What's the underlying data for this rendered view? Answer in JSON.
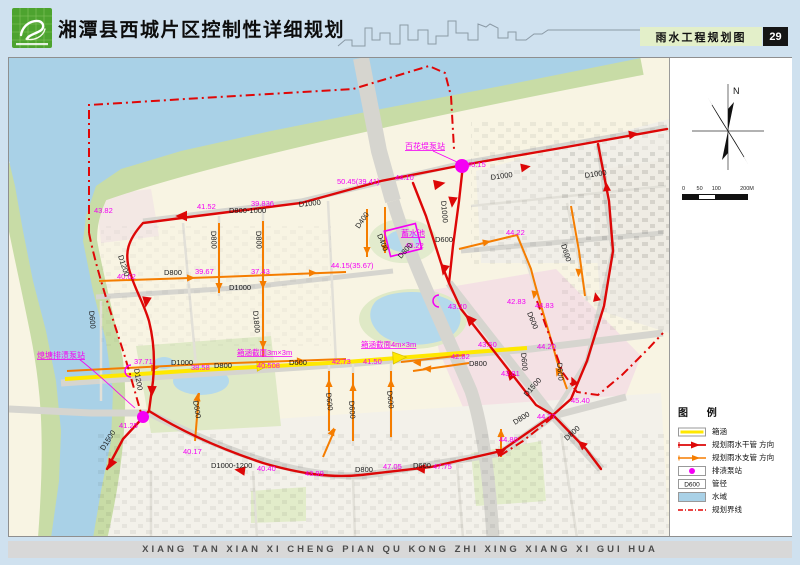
{
  "header": {
    "title": "湘潭县西城片区控制性详细规划",
    "map_label": "雨水工程规划图",
    "page_number": "29"
  },
  "footer": {
    "text": "XIANG TAN XIAN XI CHENG PIAN QU KONG ZHI XING XIANG XI GUI HUA"
  },
  "compass": {
    "north_label": "N"
  },
  "scale_bar": {
    "ticks": [
      "0",
      "50",
      "100",
      "200M"
    ]
  },
  "legend": {
    "title": "图  例",
    "items": [
      {
        "symbol": "culvert",
        "label": "箱涵"
      },
      {
        "symbol": "main-pipe",
        "label": "规划雨水干管  方向"
      },
      {
        "symbol": "branch-pipe",
        "label": "规划雨水支管  方向"
      },
      {
        "symbol": "pump-station",
        "label": "排渍泵站"
      },
      {
        "symbol": "diameter",
        "label": "管径",
        "swatch_text": "D600"
      },
      {
        "symbol": "water",
        "label": "水域"
      },
      {
        "symbol": "boundary",
        "label": "规划界线"
      }
    ]
  },
  "map": {
    "colors": {
      "main_pipe": "#dd0707",
      "branch_pipe": "#f57d00",
      "culvert": "#ffe800",
      "pump": "#f400f4",
      "water": "#a9d1e7",
      "boundary": "#e00707"
    },
    "annotations": [
      {
        "t": "43.82",
        "x": 93,
        "y": 212
      },
      {
        "t": "41.52",
        "x": 196,
        "y": 208
      },
      {
        "t": "39.836",
        "x": 250,
        "y": 205
      },
      {
        "t": "50.45(39.41)",
        "x": 336,
        "y": 183
      },
      {
        "t": "44.10",
        "x": 394,
        "y": 179
      },
      {
        "t": "百花堤泵站",
        "x": 404,
        "y": 148,
        "u": 1,
        "fs": 8
      },
      {
        "t": "40.15",
        "x": 466,
        "y": 166
      },
      {
        "t": "蓄水池",
        "x": 400,
        "y": 235,
        "u": 1,
        "fs": 8
      },
      {
        "t": "40.22",
        "x": 404,
        "y": 247
      },
      {
        "t": "44.15(35.67)",
        "x": 330,
        "y": 267
      },
      {
        "t": "44.22",
        "x": 505,
        "y": 234
      },
      {
        "t": "42.83",
        "x": 506,
        "y": 303
      },
      {
        "t": "43.20",
        "x": 447,
        "y": 308
      },
      {
        "t": "44.83",
        "x": 534,
        "y": 307
      },
      {
        "t": "43.50",
        "x": 477,
        "y": 346
      },
      {
        "t": "42.82",
        "x": 450,
        "y": 358
      },
      {
        "t": "44.20",
        "x": 536,
        "y": 348
      },
      {
        "t": "43.81",
        "x": 500,
        "y": 375
      },
      {
        "t": "42.73",
        "x": 331,
        "y": 363
      },
      {
        "t": "41.50",
        "x": 362,
        "y": 363
      },
      {
        "t": "40.508",
        "x": 256,
        "y": 367
      },
      {
        "t": "38.58",
        "x": 190,
        "y": 369
      },
      {
        "t": "37.71",
        "x": 133,
        "y": 363
      },
      {
        "t": "39.67",
        "x": 194,
        "y": 273
      },
      {
        "t": "37.43",
        "x": 250,
        "y": 273
      },
      {
        "t": "40.62",
        "x": 116,
        "y": 278
      },
      {
        "t": "熄塘排渍泵站",
        "x": 36,
        "y": 357,
        "u": 1,
        "fs": 8
      },
      {
        "t": "41.25",
        "x": 118,
        "y": 427
      },
      {
        "t": "40.17",
        "x": 182,
        "y": 453
      },
      {
        "t": "40.40",
        "x": 256,
        "y": 470
      },
      {
        "t": "43.99",
        "x": 304,
        "y": 475
      },
      {
        "t": "47.05",
        "x": 382,
        "y": 468
      },
      {
        "t": "47.75",
        "x": 432,
        "y": 468
      },
      {
        "t": "44.80",
        "x": 498,
        "y": 441
      },
      {
        "t": "44.77",
        "x": 536,
        "y": 418
      },
      {
        "t": "45.40",
        "x": 570,
        "y": 402
      },
      {
        "t": "箱涵截面3m×3m",
        "x": 236,
        "y": 354,
        "u": 1
      },
      {
        "t": "箱涵截面4m×3m",
        "x": 360,
        "y": 346,
        "u": 1
      },
      {
        "t": "D800-1000",
        "x": 228,
        "y": 212,
        "c": "k"
      },
      {
        "t": "D1000",
        "x": 298,
        "y": 206,
        "c": "k",
        "r": -6
      },
      {
        "t": "D1000",
        "x": 490,
        "y": 179,
        "c": "k",
        "r": -8
      },
      {
        "t": "D1000",
        "x": 584,
        "y": 177,
        "c": "k",
        "r": -8
      },
      {
        "t": "D1000",
        "x": 440,
        "y": 200,
        "c": "k",
        "r": 85
      },
      {
        "t": "D800",
        "x": 210,
        "y": 230,
        "c": "k",
        "r": 88
      },
      {
        "t": "D800",
        "x": 255,
        "y": 230,
        "c": "k",
        "r": 88
      },
      {
        "t": "D1200",
        "x": 117,
        "y": 255,
        "c": "k",
        "r": 72
      },
      {
        "t": "D800",
        "x": 163,
        "y": 274,
        "c": "k"
      },
      {
        "t": "D1000",
        "x": 228,
        "y": 289,
        "c": "k"
      },
      {
        "t": "D1800",
        "x": 252,
        "y": 310,
        "c": "k",
        "r": 85
      },
      {
        "t": "D600",
        "x": 88,
        "y": 310,
        "c": "k",
        "r": 85
      },
      {
        "t": "D1200",
        "x": 133,
        "y": 368,
        "c": "k",
        "r": 80
      },
      {
        "t": "D1000",
        "x": 170,
        "y": 364,
        "c": "k"
      },
      {
        "t": "D800",
        "x": 213,
        "y": 367,
        "c": "k"
      },
      {
        "t": "D600",
        "x": 288,
        "y": 364,
        "c": "k"
      },
      {
        "t": "D400",
        "x": 358,
        "y": 228,
        "c": "k",
        "r": -55
      },
      {
        "t": "D400",
        "x": 376,
        "y": 234,
        "c": "k",
        "r": 68
      },
      {
        "t": "D800",
        "x": 400,
        "y": 258,
        "c": "k",
        "r": -48
      },
      {
        "t": "D600",
        "x": 434,
        "y": 241,
        "c": "k"
      },
      {
        "t": "D600",
        "x": 325,
        "y": 392,
        "c": "k",
        "r": 84
      },
      {
        "t": "D600",
        "x": 348,
        "y": 400,
        "c": "k",
        "r": 86
      },
      {
        "t": "D600",
        "x": 386,
        "y": 390,
        "c": "k",
        "r": 84
      },
      {
        "t": "D600",
        "x": 192,
        "y": 400,
        "c": "k",
        "r": 80
      },
      {
        "t": "D1500",
        "x": 103,
        "y": 450,
        "c": "k",
        "r": -58
      },
      {
        "t": "D1000-1200",
        "x": 210,
        "y": 467,
        "c": "k"
      },
      {
        "t": "D800",
        "x": 354,
        "y": 471,
        "c": "k"
      },
      {
        "t": "D600",
        "x": 412,
        "y": 467,
        "c": "k"
      },
      {
        "t": "D600",
        "x": 526,
        "y": 312,
        "c": "k",
        "r": 68
      },
      {
        "t": "D600",
        "x": 520,
        "y": 352,
        "c": "k",
        "r": 85
      },
      {
        "t": "D600",
        "x": 556,
        "y": 362,
        "c": "k",
        "r": 85
      },
      {
        "t": "D600",
        "x": 560,
        "y": 244,
        "c": "k",
        "r": 72
      },
      {
        "t": "D1500",
        "x": 526,
        "y": 396,
        "c": "k",
        "r": -48
      },
      {
        "t": "D800",
        "x": 514,
        "y": 424,
        "c": "k",
        "r": -32
      },
      {
        "t": "D800",
        "x": 566,
        "y": 440,
        "c": "k",
        "r": -42
      },
      {
        "t": "D800",
        "x": 468,
        "y": 365,
        "c": "k"
      }
    ]
  }
}
